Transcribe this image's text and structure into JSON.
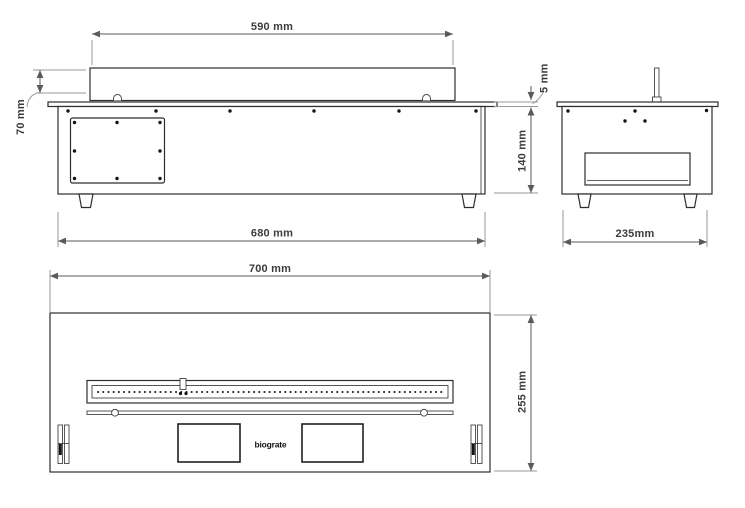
{
  "colors": {
    "background": "#ffffff",
    "object_line": "#2d2d2d",
    "dimension_line": "#5a5a5a",
    "extension_line": "#9a9a9a",
    "dimension_text": "#3c3c3c"
  },
  "views": {
    "front": {
      "dim_insert_width": "590 mm",
      "dim_insert_height": "70 mm",
      "dim_body_width": "680 mm"
    },
    "side": {
      "dim_top_plate_thickness": "5 mm",
      "dim_body_height": "140 mm",
      "dim_body_depth": "235mm"
    },
    "top": {
      "dim_body_width": "700 mm",
      "dim_body_depth": "255 mm",
      "brand_label": "biograte"
    }
  }
}
